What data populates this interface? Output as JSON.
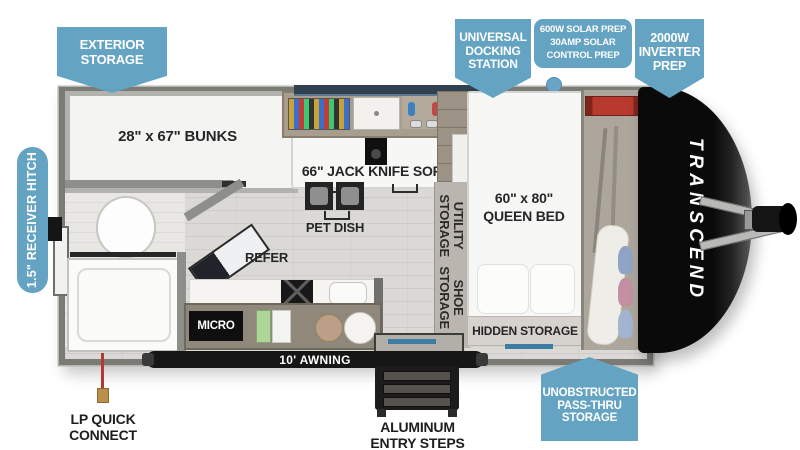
{
  "meta": {
    "accent_blue": "#64a3c2",
    "label_color": "#262626",
    "cap_color": "#0a0a0a"
  },
  "callouts": {
    "exterior_storage": {
      "line1": "EXTERIOR",
      "line2": "STORAGE"
    },
    "universal_docking_station": {
      "line1": "UNIVERSAL",
      "line2": "DOCKING",
      "line3": "STATION"
    },
    "solar_prep": {
      "line1": "600W SOLAR PREP",
      "line2": "30AMP SOLAR",
      "line3": "CONTROL PREP"
    },
    "inverter_prep": {
      "line1": "2000W",
      "line2": "INVERTER",
      "line3": "PREP"
    },
    "unobstructed_pass_thru": {
      "line1": "UNOBSTRUCTED",
      "line2": "PASS-THRU",
      "line3": "STORAGE"
    },
    "receiver_hitch": {
      "label": "1.5\" RECEIVER HITCH"
    }
  },
  "floorplan": {
    "brand_vertical": "TRANSCEND",
    "rooms": {
      "bunks": "28\" x 67\" BUNKS",
      "sofa": "66\" JACK KNIFE SOFA",
      "pet_dish": "PET DISH",
      "refer": "REFER",
      "micro": "MICRO",
      "utility_storage": {
        "line1": "UTILITY",
        "line2": "STORAGE"
      },
      "shoe_storage": {
        "line1": "SHOE",
        "line2": "STORAGE"
      },
      "queen_bed": {
        "line1": "60\" x 80\"",
        "line2": "QUEEN BED"
      },
      "hidden_storage": "HIDDEN STORAGE"
    },
    "exterior": {
      "awning": "10' AWNING",
      "entry_steps": {
        "line1": "ALUMINUM",
        "line2": "ENTRY STEPS"
      },
      "lp_quick_connect": {
        "line1": "LP QUICK",
        "line2": "CONNECT"
      }
    }
  }
}
